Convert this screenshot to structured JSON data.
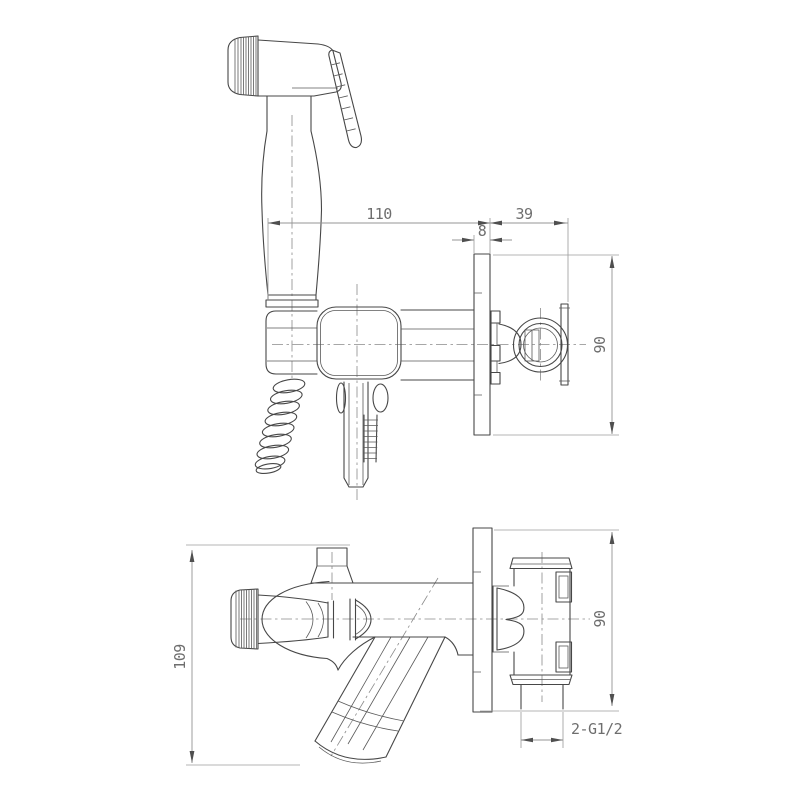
{
  "page": {
    "background": "#ffffff"
  },
  "drawing": {
    "type": "technical-dimension-drawing",
    "subject": "wall-mounted hygienic hand shower (bidet) mixer - installation diagram",
    "views": [
      {
        "id": "side-view",
        "label": "front elevation with hand sprayer"
      },
      {
        "id": "top-view",
        "label": "top view with spout and wall connections"
      }
    ],
    "colors": {
      "object_line": "#474747",
      "dimension_line": "#949494",
      "centerline": "#8a8a8a",
      "text": "#6e6e6e",
      "background": "#ffffff"
    }
  },
  "dimensions": {
    "side": [
      {
        "id": "dim-110",
        "value": "110"
      },
      {
        "id": "dim-39",
        "value": "39"
      },
      {
        "id": "dim-8",
        "value": "8"
      },
      {
        "id": "dim-90",
        "value": "90"
      }
    ],
    "top": [
      {
        "id": "dim-109",
        "value": "109"
      },
      {
        "id": "dim-90",
        "value": "90"
      },
      {
        "id": "thread-label",
        "value": "2-G1/2"
      }
    ]
  }
}
